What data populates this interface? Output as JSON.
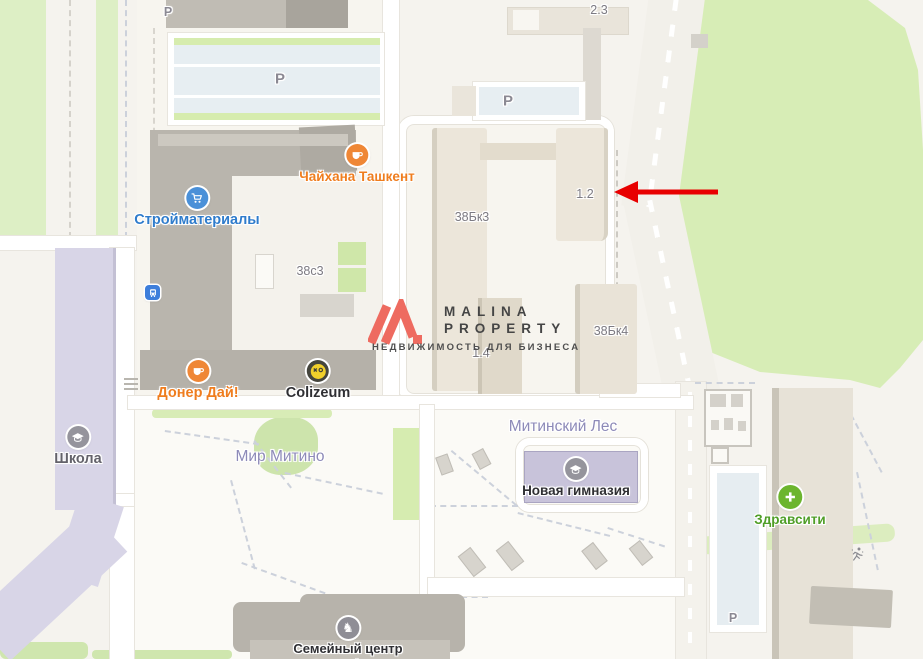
{
  "logo": {
    "line1": "MALINA",
    "line2": "PROPERTY",
    "tagline": "НЕДВИЖИМОСТЬ ДЛЯ БИЗНЕСА"
  },
  "labels": {
    "parking": "P",
    "b23": "2.3",
    "b38s3": "38с3",
    "b38bk3": "38Бк3",
    "b12": "1.2",
    "b14": "1.4",
    "b38bk4": "38Бк4",
    "mir_mitino": "Мир Митино",
    "mitinsky_les": "Митинский Лес"
  },
  "poi": {
    "chaihana": "Чайхана Ташкент",
    "stroymaterialy": "Стройматериалы",
    "doner": "Донер Дай!",
    "colizeum": "Colizeum",
    "shkola": "Школа",
    "gymnasium": "Новая гимназия",
    "zdravsiti": "Здравсити",
    "family_center_line1": "Семейный центр",
    "family_center_line2": "Атмосфера"
  },
  "icons": {
    "chaihana": "teacup-icon",
    "stroymaterialy": "shopping-cart-icon",
    "doner": "teacup-icon",
    "colizeum": "gaming-smiley-icon",
    "shkola": "graduation-cap-icon",
    "gymnasium": "graduation-cap-icon",
    "zdravsiti": "medical-plus-icon",
    "family_center": "rocking-horse-icon",
    "bus_stop": "bus-stop-icon",
    "sports": "runner-icon",
    "family_center_glyph": "♞"
  },
  "colors": {
    "arrow": "#e80000",
    "logo_accent": "#ee6b60",
    "poi_orange": "#ef7d1e",
    "poi_blue": "#2f7ccc",
    "poi_green": "#4f9e27",
    "area_label": "#8d8ab8",
    "building_label": "#7c7a82"
  }
}
